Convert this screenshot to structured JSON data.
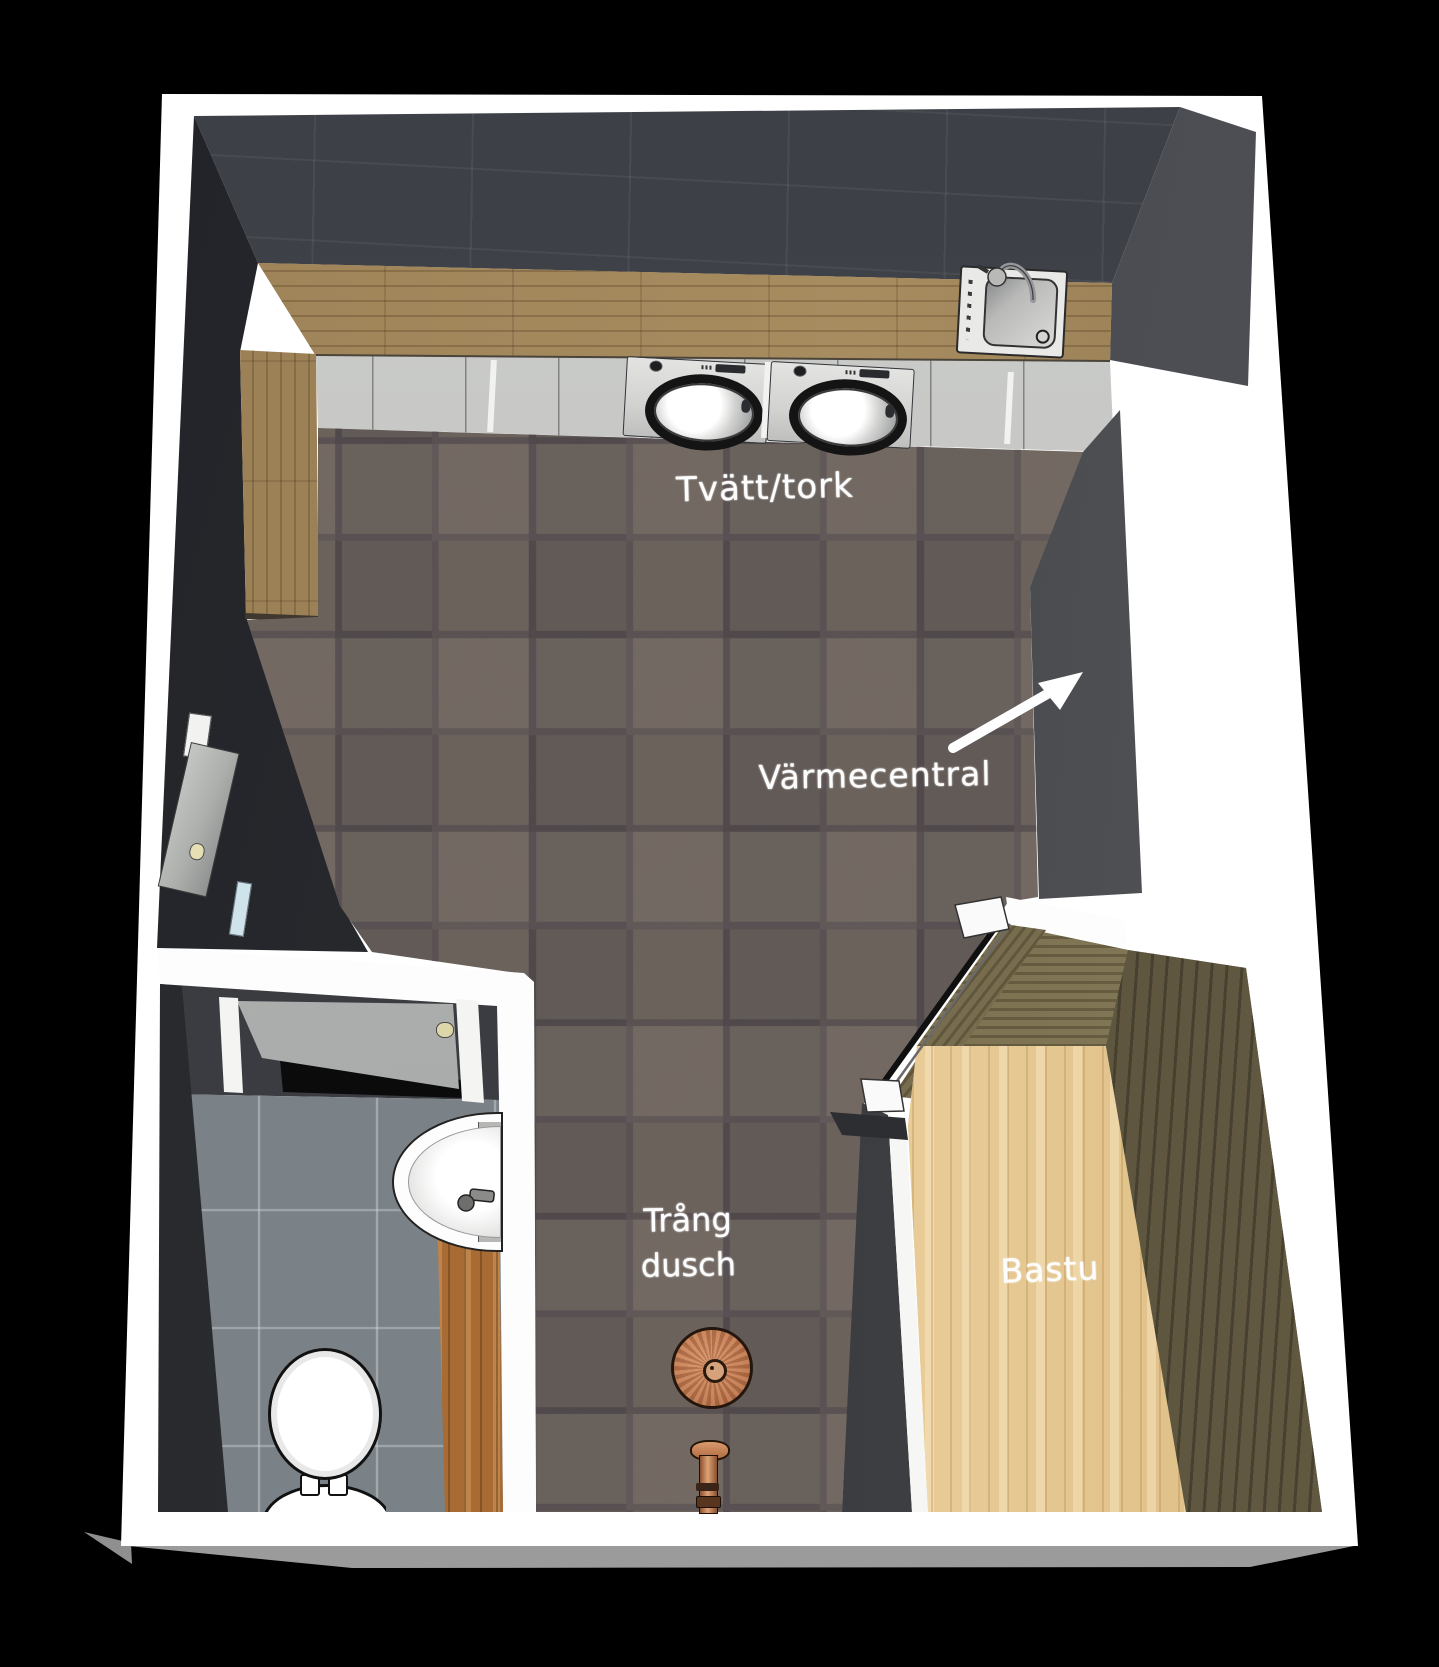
{
  "scene": {
    "title": "Badrum/tvättstuga planritning",
    "type": "3D floor plan rendering (top-down)",
    "rooms": [
      "Tvätt/tork",
      "WC",
      "Trång dusch",
      "Bastu"
    ],
    "annotation_arrow_target": "Värmecentral"
  },
  "labels": {
    "laundry": "Tvätt/tork",
    "heating": "Värmecentral",
    "shower_line1": "Trång",
    "shower_line2": "dusch",
    "sauna": "Bastu"
  },
  "fixtures": [
    "kitchen-sink-with-faucet",
    "washing-machine",
    "drying-machine",
    "base-cabinets",
    "wood-countertop",
    "room-door-left-wall",
    "wc-door-open",
    "wc-wall-sink-with-faucet",
    "toilet",
    "wood-bench-strip",
    "rain-shower-head-copper",
    "shower-mixer-copper",
    "sauna-glass-door-diagonal",
    "sauna-pine-floor"
  ],
  "colors": {
    "background": "#000000",
    "outer_wall_top": "#ffffff",
    "dark_tiled_wall": "#42454c",
    "floor_tile": "#6e6661",
    "floor_grout": "#5a5356",
    "wood_counter": "#9c8156",
    "cabinet_front": "#c6c7c5",
    "wc_floor_tile": "#7b8287",
    "wc_wood_strip": "#a86b34",
    "sauna_pine": "#e6c792",
    "sauna_dark_wood": "#574f3a",
    "sauna_olive_band": "#7d7252",
    "copper_fixture": "#c47b51",
    "annotation_text": "#fdfdfd"
  }
}
